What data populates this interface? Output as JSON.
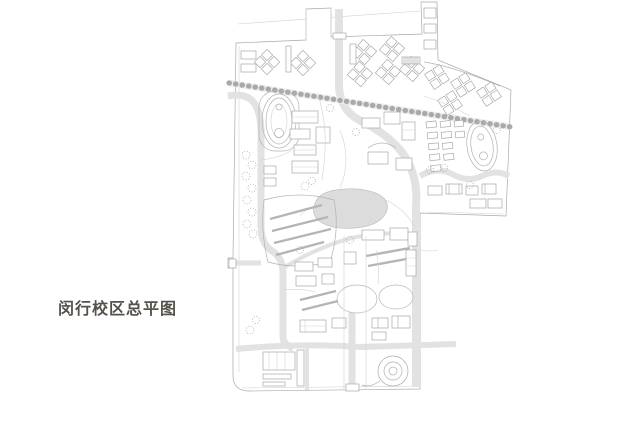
{
  "title": {
    "text": "闵行校区总平图"
  },
  "map": {
    "name": "minhang-campus-master-plan",
    "type": "architectural site plan line drawing",
    "colors": {
      "paper": "#ffffff",
      "line": "#b2b2b2",
      "dark_line": "#9d9d9d",
      "road_fill": "#e2e2e2",
      "water_fill": "#dcdcdc",
      "title_text": "#55514b"
    },
    "features": [
      {
        "name": "campus-boundary"
      },
      {
        "name": "north-gate-road"
      },
      {
        "name": "tree-lined-avenue"
      },
      {
        "name": "northwest-dormitory-pinwheels"
      },
      {
        "name": "northeast-dormitory-pinwheels"
      },
      {
        "name": "east-annex-dormitory-cluster"
      },
      {
        "name": "west-stadium-track"
      },
      {
        "name": "east-stadium-track"
      },
      {
        "name": "central-lake"
      },
      {
        "name": "teaching-building-cluster-west"
      },
      {
        "name": "teaching-building-cluster-east"
      },
      {
        "name": "terraced-housing-rows"
      },
      {
        "name": "south-academic-cluster"
      },
      {
        "name": "round-gymnasium"
      },
      {
        "name": "south-gate-axis"
      },
      {
        "name": "southwest-dormitory-block"
      },
      {
        "name": "west-entrance-road"
      },
      {
        "name": "perimeter-greenery"
      }
    ]
  }
}
